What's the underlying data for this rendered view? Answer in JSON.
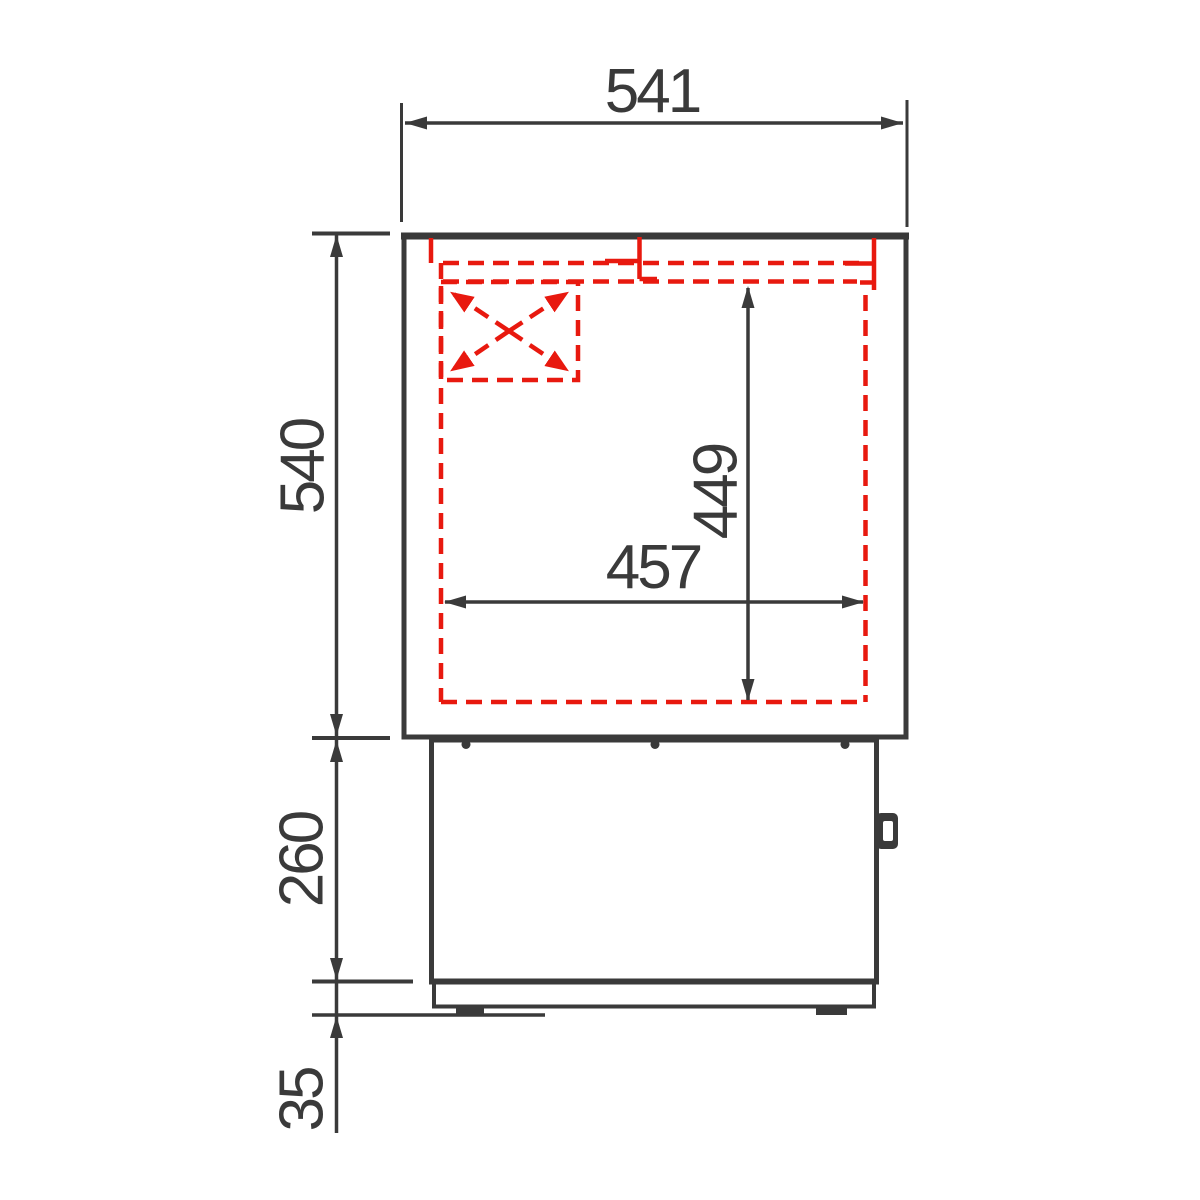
{
  "drawing": {
    "description": "Technical side-section drawing of a counter / refrigerated cabinet with highlighted interior chamber",
    "colors": {
      "background": "#ffffff",
      "line": "#3a3a3a",
      "highlight": "#e8190f"
    },
    "dimensions": {
      "overall_width": "541",
      "body_height": "540",
      "base_height": "260",
      "plinth_height": "35",
      "inner_height": "449",
      "inner_width": "457"
    }
  }
}
